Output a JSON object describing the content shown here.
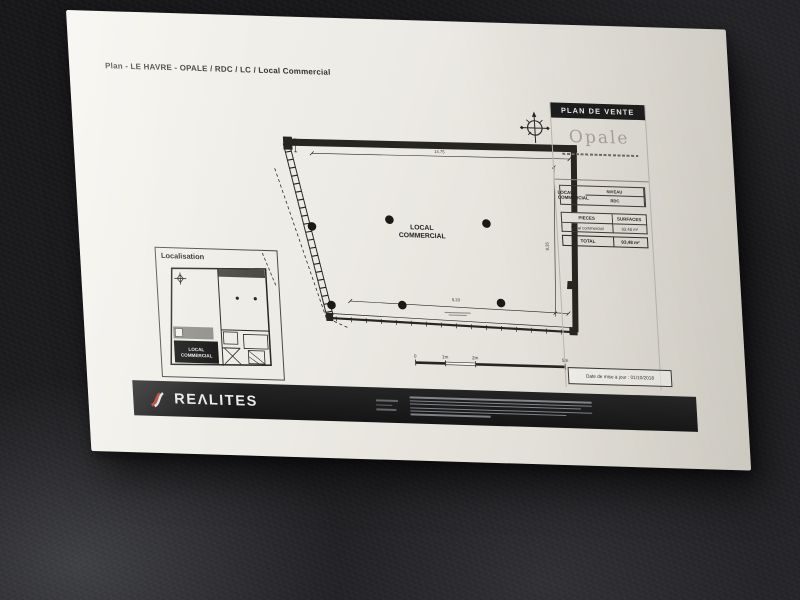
{
  "photo": {
    "desk_color": "#1c1c1f",
    "paper_color": "#ece9e2",
    "brand_red": "#c0392b"
  },
  "document": {
    "title": "Plan - LE HAVRE - OPALE / RDC / LC / Local Commercial",
    "plan": {
      "room_line1": "LOCAL",
      "room_line2": "COMMERCIAL",
      "dim_top": "14,75",
      "dim_right": "8,35",
      "dim_bottom": "9,20"
    },
    "scalebar": {
      "t0": "0",
      "t1": "1m",
      "t2": "2m",
      "t5": "5m"
    },
    "localisation": {
      "label": "Localisation",
      "room_line1": "LOCAL",
      "room_line2": "COMMERCIAL"
    },
    "titleblock": {
      "header": "PLAN DE VENTE",
      "brand": "Opale",
      "niveau_label": "NIVEAU",
      "niveau_value": "RDC",
      "lot_name": "LOCAL COMMERCIAL",
      "col_pieces": "PIECES",
      "col_surfaces": "SURFACES",
      "row_piece": "Local commercial",
      "row_surface": "93,48 m²",
      "total_label": "TOTAL",
      "total_value": "93,48 m²",
      "date_line": "Date de mise à jour : 01/10/2018"
    },
    "footer": {
      "brand": "REΛLITES"
    }
  }
}
